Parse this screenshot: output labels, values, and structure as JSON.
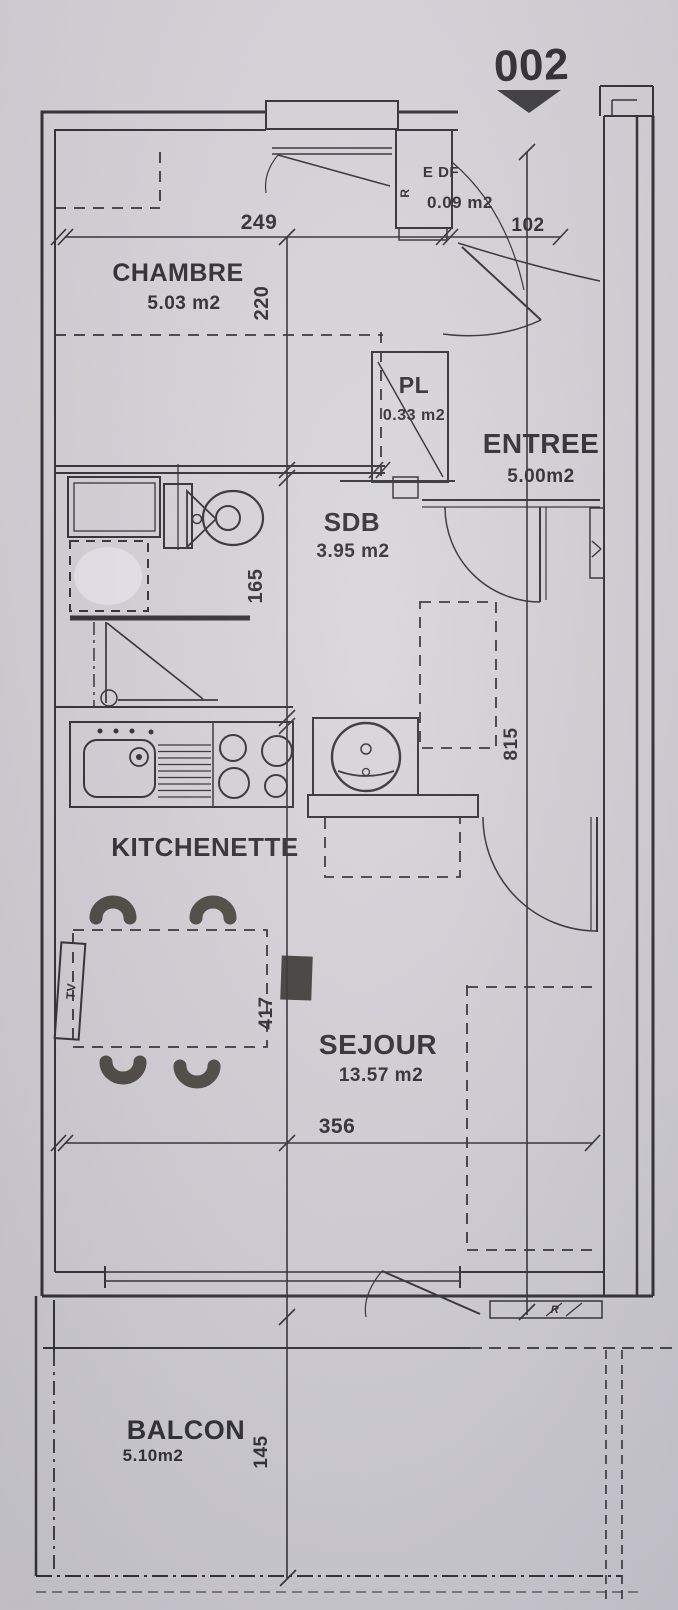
{
  "unit": {
    "number": "002"
  },
  "rooms": {
    "chambre": {
      "name": "CHAMBRE",
      "area": "5.03 m2"
    },
    "edf": {
      "name": "E DF",
      "area": "0.09 m2"
    },
    "pl": {
      "name": "PL",
      "area": "0.33 m2"
    },
    "entree": {
      "name": "ENTREE",
      "area": "5.00m2"
    },
    "sdb": {
      "name": "SDB",
      "area": "3.95 m2"
    },
    "kitchenette": {
      "name": "KITCHENETTE"
    },
    "sejour": {
      "name": "SEJOUR",
      "area": "13.57 m2"
    },
    "balcon": {
      "name": "BALCON",
      "area": "5.10m2"
    }
  },
  "dimensions": {
    "chambre_width": "249",
    "entry_width": "102",
    "chambre_depth": "220",
    "sdb_depth": "165",
    "apartment_depth": "815",
    "sejour_depth": "417",
    "sejour_width": "356",
    "balcon_depth": "145"
  },
  "annotations": {
    "tv": "TV",
    "meter_mark": "R",
    "radiator_mark": "R"
  },
  "colors": {
    "paper": "#d6d4d9",
    "ink": "#2b2a30",
    "furniture": "#49463f"
  }
}
